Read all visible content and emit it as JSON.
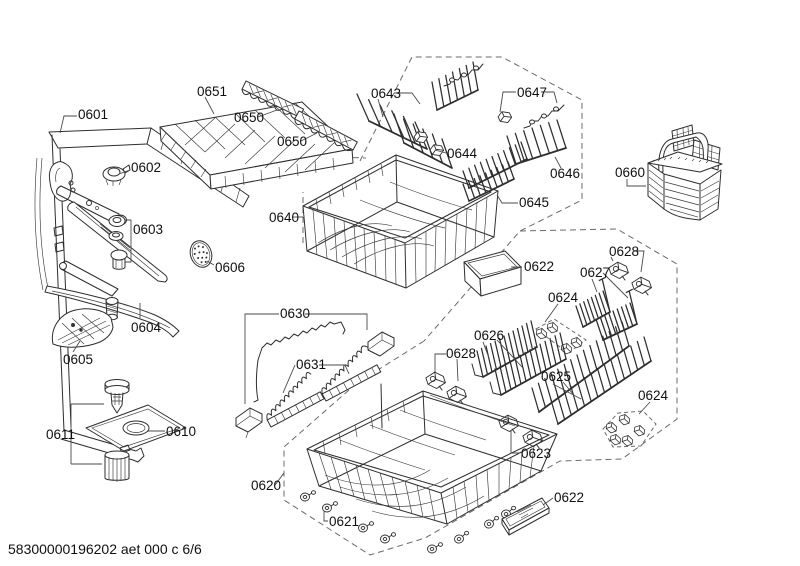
{
  "document": {
    "footer_code": "58300000196202 aet 000 c 6/6"
  },
  "colors": {
    "background": "#ffffff",
    "line": "#2e2e2e",
    "label_text": "#101010",
    "dashed_boundary": "#6b6b6b"
  },
  "parts": {
    "p0601": "0601",
    "p0602": "0602",
    "p0603": "0603",
    "p0604": "0604",
    "p0605": "0605",
    "p0606": "0606",
    "p0610": "0610",
    "p0611": "0611",
    "p0620": "0620",
    "p0621": "0621",
    "p0622a": "0622",
    "p0622b": "0622",
    "p0623": "0623",
    "p0624a": "0624",
    "p0624b": "0624",
    "p0625": "0625",
    "p0626": "0626",
    "p0627": "0627",
    "p0628a": "0628",
    "p0628b": "0628",
    "p0630": "0630",
    "p0631": "0631",
    "p0640": "0640",
    "p0643": "0643",
    "p0644": "0644",
    "p0645": "0645",
    "p0646": "0646",
    "p0647": "0647",
    "p0650a": "0650",
    "p0650b": "0650",
    "p0651": "0651",
    "p0660": "0660"
  }
}
